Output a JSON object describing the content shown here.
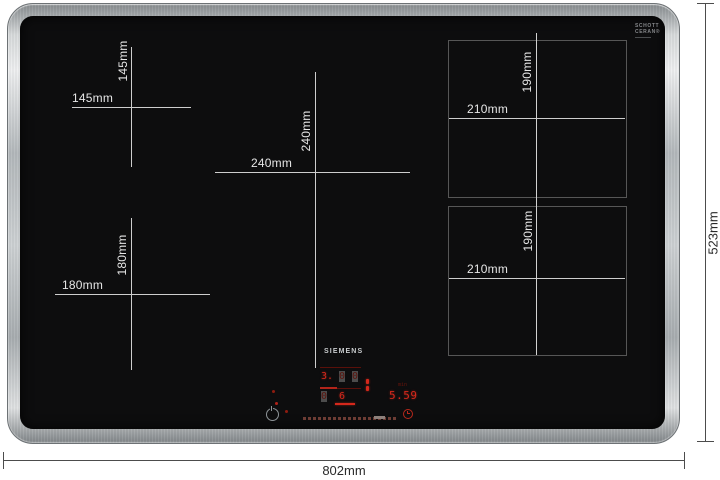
{
  "diagram": {
    "product": "induction-hob-dimension-diagram",
    "brand": "SIEMENS",
    "glass_logo": {
      "line1": "SCHOTT",
      "line2": "CERAN®"
    }
  },
  "zones": {
    "left_top": {
      "width": "145mm",
      "height": "145mm"
    },
    "center": {
      "width": "240mm",
      "height": "240mm"
    },
    "left_bottom": {
      "width": "180mm",
      "height": "180mm"
    },
    "flex_top": {
      "width": "210mm",
      "height": "190mm"
    },
    "flex_bottom": {
      "width": "210mm",
      "height": "190mm"
    }
  },
  "overall_dimensions": {
    "width": "802mm",
    "height": "523mm"
  },
  "control_panel": {
    "power_levels": {
      "zone_a": "3.",
      "zone_b": "0",
      "zone_c": "0",
      "zone_d": "0",
      "selected": "6"
    },
    "timer": {
      "value": "5.59",
      "unit": "min"
    }
  },
  "colors": {
    "led_bright": "#d5281c",
    "led_dim": "#5c140d",
    "glass": "#0d0d0e",
    "frame_steel": "#c0c4c7",
    "zone_line": "#cdcdcd",
    "dimension_line": "#4c4c4c"
  }
}
